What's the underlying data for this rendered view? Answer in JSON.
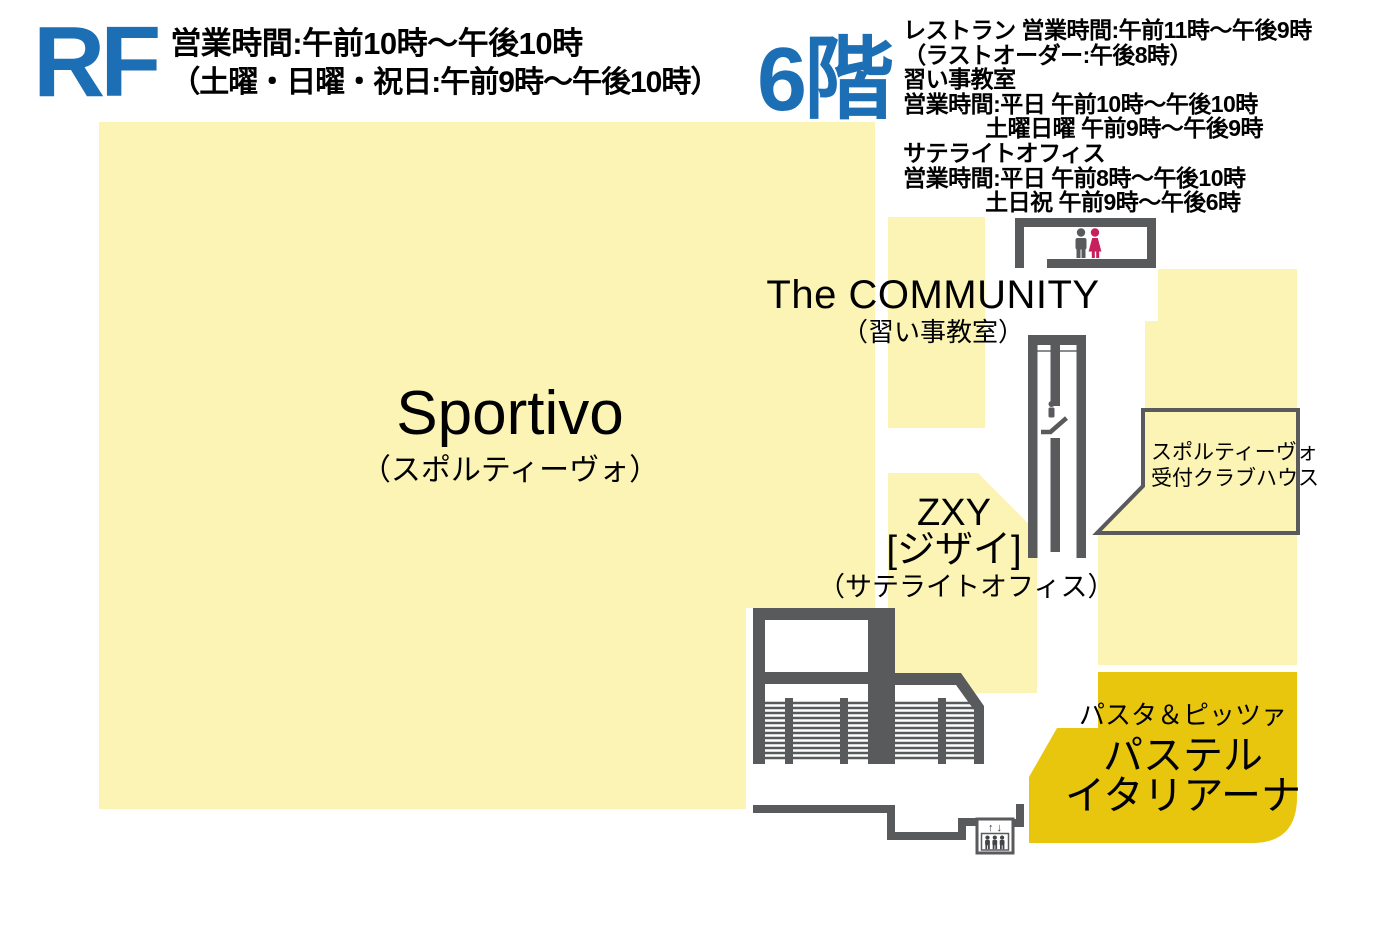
{
  "rf_section": {
    "floor_label": "RF",
    "hours_line1": "営業時間:午前10時～午後10時",
    "hours_line2": "（土曜・日曜・祝日:午前9時～午後10時）"
  },
  "f6_section": {
    "floor_label": "6階",
    "info_lines": [
      "レストラン 営業時間:午前11時～午後9時",
      "（ラストオーダー:午後8時）",
      "習い事教室",
      "営業時間:平日 午前10時～午後10時",
      "土曜日曜 午前9時～午後9時",
      "サテライトオフィス",
      "営業時間:平日 午前8時～午後10時",
      "土日祝 午前9時～午後6時"
    ]
  },
  "areas": {
    "sportivo": {
      "name": "Sportivo",
      "reading": "（スポルティーヴォ）"
    },
    "community": {
      "name": "The COMMUNITY",
      "category": "（習い事教室）"
    },
    "zxy": {
      "name": "ZXY",
      "reading": "[ジザイ]",
      "category": "（サテライトオフィス）"
    },
    "reception": {
      "line1": "スポルティーヴォ",
      "line2": "受付クラブハウス"
    },
    "pastel_italiana": {
      "category": "パスタ＆ピッツァ",
      "name_line1": "パステル",
      "name_line2": "イタリアーナ"
    }
  },
  "elevator": {
    "arrows_label": "↑ ↓"
  },
  "colors": {
    "accent_blue": "#1C6FB5",
    "area_pale_yellow": "#FBF4B4",
    "area_gold": "#E8C60D",
    "wall_gray": "#595A5C",
    "female_icon_pink": "#C6215C",
    "text_black": "#000000"
  }
}
